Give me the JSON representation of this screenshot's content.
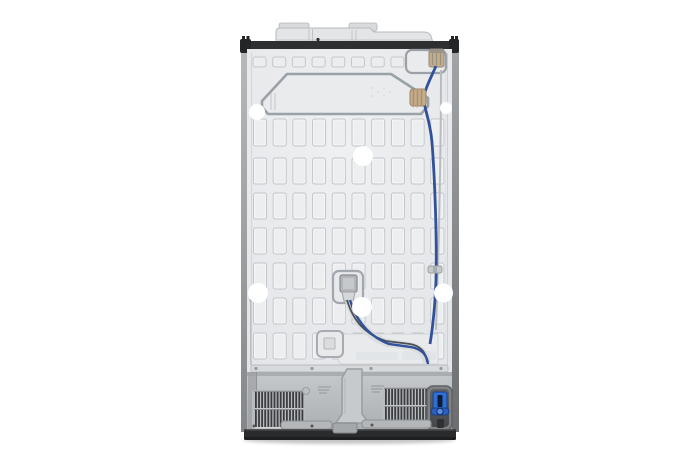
{
  "scene": {
    "subject": "refrigerator-back-view",
    "description": "rear panel of side-by-side refrigerator with water line"
  },
  "colors": {
    "background": "#ffffff",
    "top_strip": "#2e2f31",
    "cap": "#e3e5e7",
    "panel": "#e7e9eb",
    "slot_fill": "#eceef0",
    "slot_stroke": "#c2c5c9",
    "slot_highlight": "#f7f8f9",
    "tab_fill": "#ebedef",
    "tab_stroke": "#c5c8cb",
    "emboss_stroke": "#9aa1a7",
    "crease": "#d0d3d6",
    "compartment_top": "#c6c9cc",
    "compartment_bottom": "#acafb2",
    "grille_slat": "#3b3d40",
    "rail": "#d7dadc",
    "base": "#2a2b2d",
    "base_dark": "#1d1e20",
    "side_left": "#a9acaf",
    "side_right": "#8b8e91",
    "corner_black": "#242527",
    "tube_blue": "#32519b",
    "wire_dark": "#4c5056",
    "wire_gray": "#b9bcbf",
    "connector_tan": "#c5ad8c",
    "connector_tan_dark": "#9b8566",
    "valve_blue": "#2e6fd4",
    "valve_blue_dark": "#1c3f85",
    "sticker": "#ffffff"
  },
  "panel": {
    "top_tabs": {
      "count": 9,
      "x0": 253,
      "y": 57,
      "pitch": 19.7,
      "w": 13,
      "h": 10
    },
    "slots": {
      "cols": 10,
      "x0": 253.5,
      "pitch": 19.7,
      "w": 13,
      "rows": [
        {
          "y": 119,
          "h": 27
        },
        {
          "y": 158,
          "h": 26
        },
        {
          "y": 193,
          "h": 26
        },
        {
          "y": 228,
          "h": 26
        },
        {
          "y": 263,
          "h": 26
        },
        {
          "y": 298,
          "h": 26
        },
        {
          "y": 333,
          "h": 26
        }
      ]
    }
  },
  "grilles": {
    "list": [
      {
        "name": "left-vent-grille",
        "x": 255,
        "w": 47,
        "slat_w": 1.8,
        "pitch": 3.1,
        "bands": [
          {
            "y": 392,
            "h": 16
          },
          {
            "y": 410,
            "h": 17
          }
        ]
      },
      {
        "name": "right-vent-grille",
        "x": 385,
        "w": 44,
        "slat_w": 1.8,
        "pitch": 3.1,
        "bands": [
          {
            "y": 389,
            "h": 16
          },
          {
            "y": 407,
            "h": 17
          }
        ]
      }
    ]
  },
  "stickers": [
    {
      "cx": 257,
      "cy": 112,
      "r": 8
    },
    {
      "cx": 363,
      "cy": 156,
      "r": 10
    },
    {
      "cx": 258,
      "cy": 293,
      "r": 10
    },
    {
      "cx": 362,
      "cy": 307,
      "r": 10
    },
    {
      "cx": 443.5,
      "cy": 293,
      "r": 9.5
    },
    {
      "cx": 446,
      "cy": 108,
      "r": 6
    }
  ]
}
